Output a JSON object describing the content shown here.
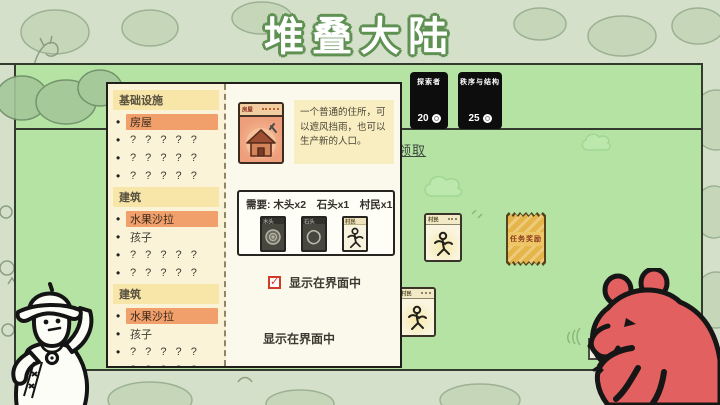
{
  "title": "堆叠大陆",
  "icons": {
    "bullet": "•",
    "check": "✓"
  },
  "cardopedia": {
    "sections": [
      {
        "header": "基础设施",
        "items": [
          {
            "label": "房屋",
            "highlight": true
          },
          {
            "label": "? ? ? ? ?",
            "highlight": false
          },
          {
            "label": "? ? ? ? ?",
            "highlight": false
          },
          {
            "label": "? ? ? ? ?",
            "highlight": false
          }
        ]
      },
      {
        "header": "建筑",
        "items": [
          {
            "label": "水果沙拉",
            "highlight": true
          },
          {
            "label": "孩子",
            "highlight": false
          },
          {
            "label": "? ? ? ? ?",
            "highlight": false
          },
          {
            "label": "? ? ? ? ?",
            "highlight": false
          }
        ]
      },
      {
        "header": "建筑",
        "items": [
          {
            "label": "水果沙拉",
            "highlight": true
          },
          {
            "label": "孩子",
            "highlight": false
          },
          {
            "label": "? ? ? ? ?",
            "highlight": false
          },
          {
            "label": "? ? ? ? ?",
            "highlight": false
          },
          {
            "label": "? ? ? ? ?",
            "highlight": false
          },
          {
            "label": "? ? ? ? ?",
            "highlight": false
          }
        ]
      }
    ],
    "detail": {
      "card_title": "房屋",
      "description": "一个普通的住所，可以遮风挡雨，也可以生产新的人口。",
      "recipe_label": "需要: 木头x2　石头x1　村民x1",
      "recipe_cards": [
        {
          "name": "木头"
        },
        {
          "name": "石头"
        },
        {
          "name": "村民"
        }
      ],
      "show_in_ui": {
        "label": "显示在界面中",
        "checked": true
      },
      "footer_label": "显示在界面中"
    }
  },
  "board": {
    "packs": [
      {
        "name": "探索者",
        "price": "20"
      },
      {
        "name": "秩序与结构",
        "price": "25"
      }
    ],
    "claim_link": "点击领取",
    "cards": [
      {
        "name": "村民"
      },
      {
        "name": "村民"
      }
    ],
    "reward_label": "任务奖励"
  },
  "colors": {
    "background": "#d5e0ca",
    "board_green": "#b5e3a4",
    "list_cream": "#fbf3d7",
    "highlight_orange": "#f1a06c",
    "card_salmon": "#ee9e7b",
    "pack_black": "#0d0d0d",
    "reward_amber": "#e6b54a",
    "checkbox_red": "#d23b2a",
    "title_outline_green": "#5f9153"
  }
}
